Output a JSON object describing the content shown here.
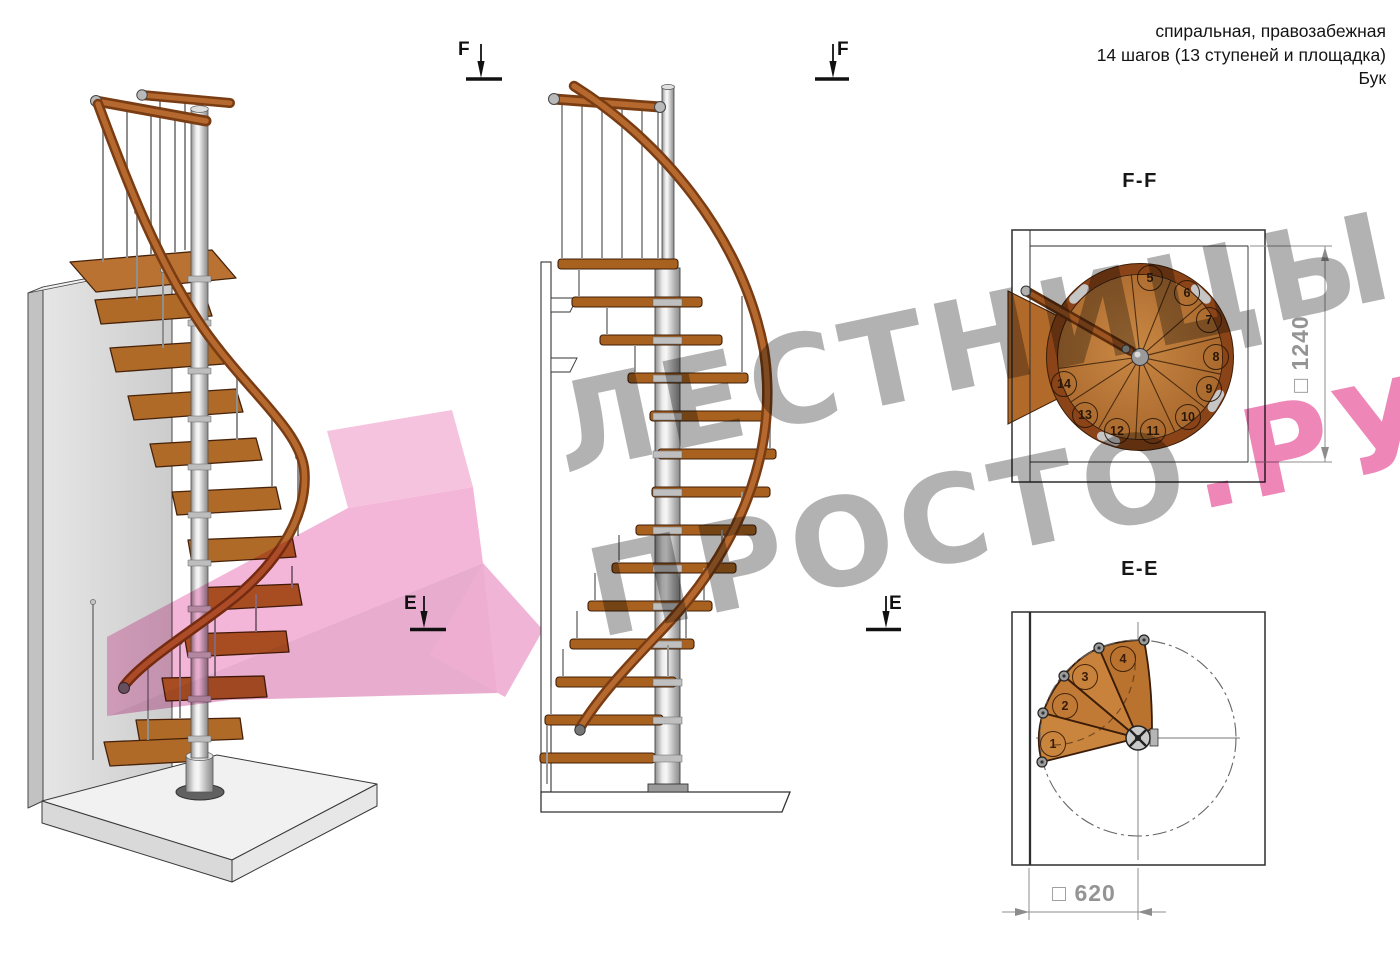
{
  "page": {
    "width": 1400,
    "height": 961,
    "background": "#ffffff"
  },
  "header": {
    "line1": "спиральная, правозабежная",
    "line2": "14 шагов (13 ступеней и площадка)",
    "line3": "Бук"
  },
  "watermark": {
    "line1": "ЛЕСТНИЦЫ",
    "line2_gray": "ПРОСТО",
    "line2_pink": ".РУ",
    "gray_color": "#b2b2b2",
    "pink_color": "#ee86b8"
  },
  "section_markers": {
    "f_left": "F",
    "f_right": "F",
    "e_left": "E",
    "e_right": "E"
  },
  "views": {
    "ff": {
      "title": "F-F",
      "dimension_label": "□ 1240",
      "step_numbers": [
        "5",
        "6",
        "7",
        "8",
        "9",
        "10",
        "11",
        "12",
        "13",
        "14"
      ]
    },
    "ee": {
      "title": "E-E",
      "dimension_label": "□ 620",
      "step_numbers": [
        "1",
        "2",
        "3",
        "4"
      ]
    }
  },
  "palette": {
    "wood": "#b06a28",
    "wood_edge": "#46220a",
    "wood_rim": "#8a4418",
    "handrail": "#7a3c12",
    "metal": "#c9c9c9",
    "wall": "#d9d9d9",
    "linework": "#2e2e2e",
    "dimension": "#949494",
    "pink_arrow": "#f2b0d5"
  }
}
